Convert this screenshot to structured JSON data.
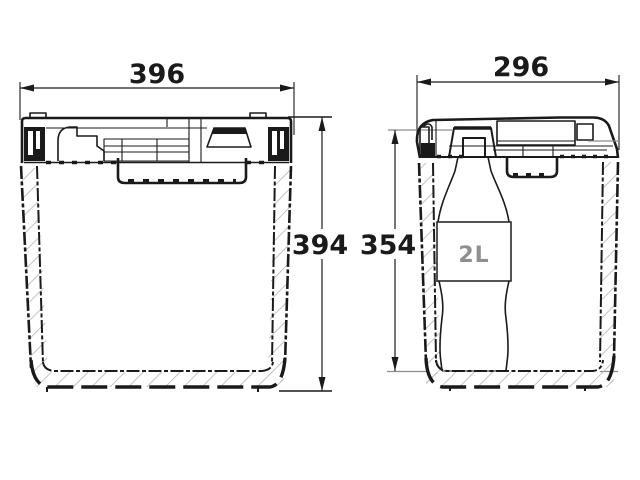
{
  "drawing": {
    "front_view": {
      "width_label": "396",
      "height_label": "394"
    },
    "side_view": {
      "width_label": "296",
      "inner_height_label": "354",
      "bottle_capacity_label": "2L"
    },
    "colors": {
      "line": "#1a1a1a",
      "hatch": "#b3b3b3",
      "dim_extension_gray": "#8c8c8c",
      "bottle_label_gray": "#8f8f8f",
      "background": "#ffffff"
    }
  }
}
